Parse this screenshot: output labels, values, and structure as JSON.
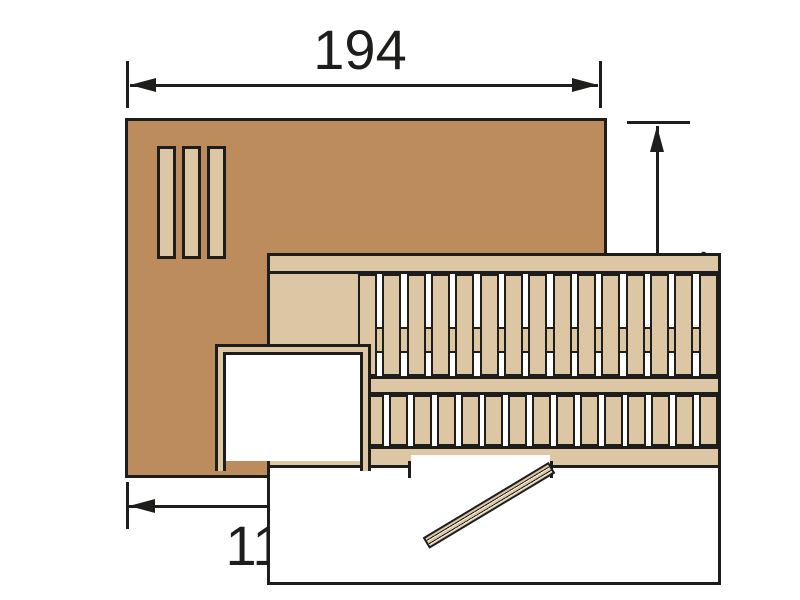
{
  "diagram": {
    "type": "sauna-floor-plan-top-view",
    "dims": {
      "width": "194",
      "depth": "144",
      "door_side": "111"
    },
    "colors": {
      "outline": "#1d1d1b",
      "wall": "#bd8c5c",
      "wood": "#dcc6a4",
      "bg": "#ffffff"
    },
    "benches": {
      "upper_slat_count": 15,
      "lower_slat_count": 19,
      "headrest_board_count": 3
    }
  }
}
